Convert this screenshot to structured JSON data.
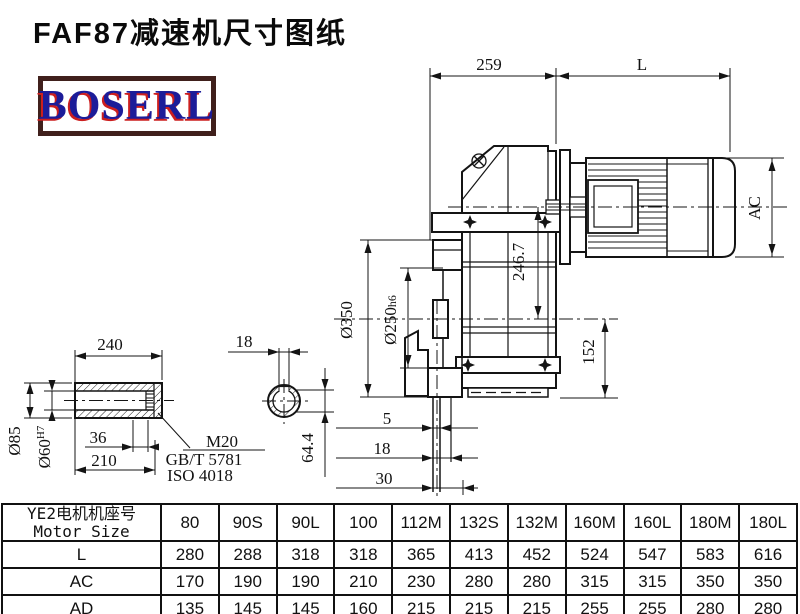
{
  "title": "FAF87减速机尺寸图纸",
  "logo": "BOSERL",
  "drawing": {
    "dims": {
      "top_width": "259",
      "motor_length_label": "L",
      "motor_diameter_label": "AC",
      "center_height": "246.7",
      "flange_diameter": "Ø350",
      "spigot_diameter": "Ø250",
      "spigot_fit": "h6",
      "shaft_to_base": "152",
      "step_5": "5",
      "step_18": "18",
      "step_30": "30",
      "keyway_depth": "64.4",
      "hub_length": "240",
      "keyway_width": "18",
      "shaft_od": "Ø85",
      "shaft_bore": "Ø60",
      "bore_fit": "H7",
      "bolt_depth": "36",
      "hub_inner_length": "210",
      "thread_spec": "M20",
      "standard_gb": "GB/T 5781",
      "standard_iso": "ISO 4018"
    }
  },
  "table": {
    "header_cn": "YE2电机机座号",
    "header_en": "Motor Size",
    "columns": [
      "80",
      "90S",
      "90L",
      "100",
      "112M",
      "132S",
      "132M",
      "160M",
      "160L",
      "180M",
      "180L"
    ],
    "rows": [
      {
        "label": "L",
        "values": [
          "280",
          "288",
          "318",
          "318",
          "365",
          "413",
          "452",
          "524",
          "547",
          "583",
          "616"
        ]
      },
      {
        "label": "AC",
        "values": [
          "170",
          "190",
          "190",
          "210",
          "230",
          "280",
          "280",
          "315",
          "315",
          "350",
          "350"
        ]
      },
      {
        "label": "AD",
        "values": [
          "135",
          "145",
          "145",
          "160",
          "215",
          "215",
          "215",
          "255",
          "255",
          "280",
          "280"
        ]
      }
    ]
  }
}
